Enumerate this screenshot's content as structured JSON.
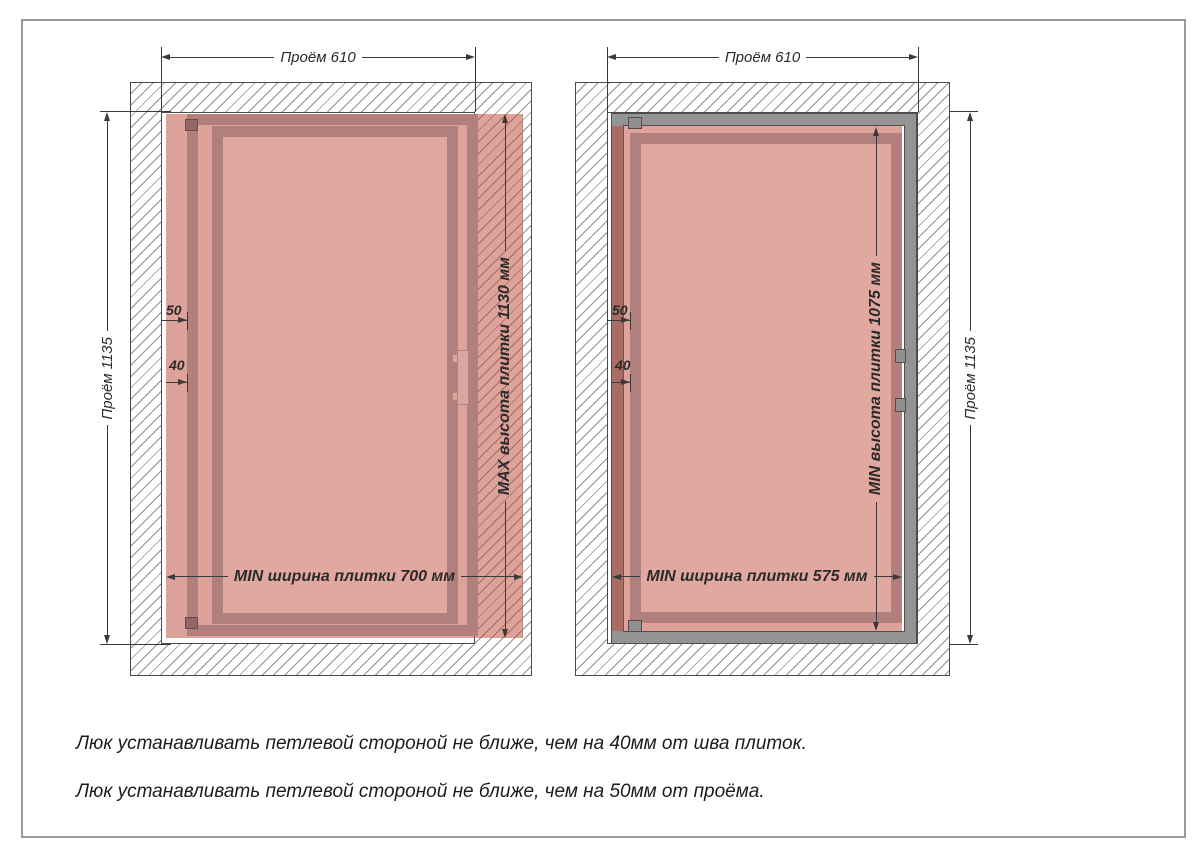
{
  "page": {
    "notes": [
      "Люк устанавливать петлевой стороной не ближе, чем на 40мм от шва плиток.",
      "Люк устанавливать петлевой стороной не ближе, чем на 50мм от проёма."
    ]
  },
  "diagrams": {
    "left": {
      "opening_width_label": "Проём 610",
      "opening_height_label": "Проём 1135",
      "tile_height_label": "MAX высота плитки 1130 мм",
      "tile_width_label": "MIN ширина плитки 700 мм",
      "hinge_to_opening_label": "50",
      "hinge_to_seam_label": "40"
    },
    "right": {
      "opening_width_label": "Проём 610",
      "opening_height_label": "Проём 1135",
      "tile_height_label": "MIN высота плитки 1075 мм",
      "tile_width_label": "MIN ширина плитки 575 мм",
      "hinge_to_opening_label": "50",
      "hinge_to_seam_label": "40"
    }
  },
  "colors": {
    "tile_fill": "rgba(187,71,53,0.5)",
    "door_frame": "#b17f7c",
    "inner_panel": "#e0a89e",
    "metal_frame": "#949494",
    "dimension_lines": "#3a3a3a",
    "hatch_lines": "#8f8f8f"
  }
}
